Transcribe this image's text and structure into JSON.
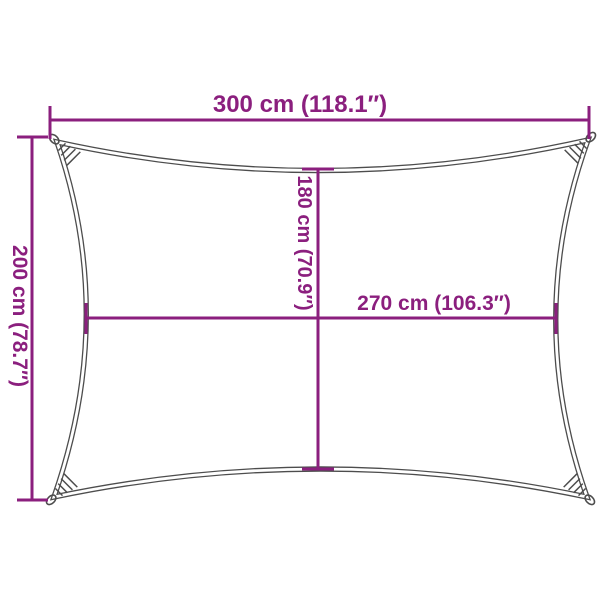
{
  "diagram": {
    "labels": {
      "width_top": "300 cm (118.1″)",
      "height_left": "200 cm (78.7″)",
      "height_center": "180 cm (70.9″)",
      "width_center": "270 cm (106.3″)"
    },
    "dimensions": {
      "width_cm": 300,
      "width_in": 118.1,
      "height_cm": 200,
      "height_in": 78.7,
      "center_width_cm": 270,
      "center_width_in": 106.3,
      "center_height_cm": 180,
      "center_height_in": 70.9
    },
    "colors": {
      "dimension": "#8B1F7E",
      "outline": "#4D4D4D",
      "background": "#FFFFFF"
    }
  }
}
